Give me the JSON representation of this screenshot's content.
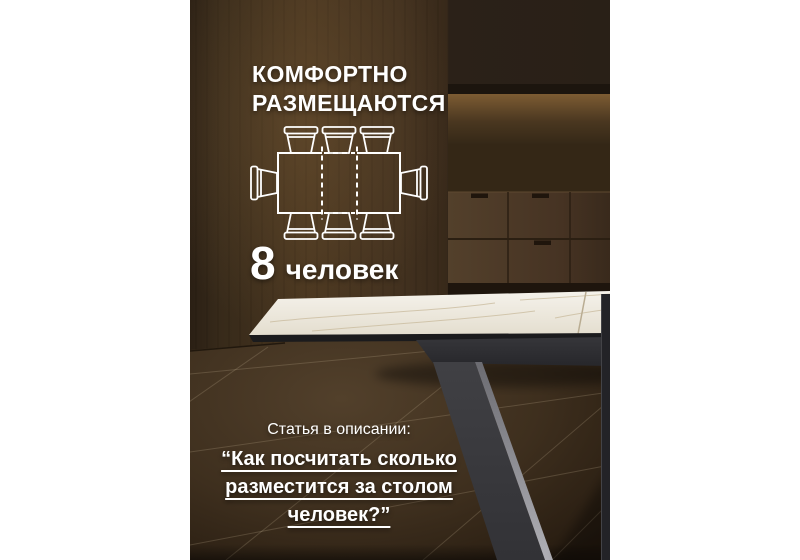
{
  "poster": {
    "heading": {
      "line1": "КОМФОРТНО",
      "line2": "РАЗМЕЩАЮТСЯ"
    },
    "capacity": {
      "number": "8",
      "label": "человек"
    },
    "footer": {
      "intro": "Статья в описании:",
      "quote_lines": {
        "0": "“Как посчитать сколько",
        "1": "разместится за столом",
        "2": "человек?”"
      }
    },
    "diagram": {
      "icon": "table-seating-top-view-icon",
      "total_seats": 8,
      "seats_top": 3,
      "seats_bottom": 3,
      "seats_left": 1,
      "seats_right": 1,
      "extension_leaf": "dashed center section"
    }
  },
  "colors": {
    "page_margin": "#ffffff",
    "overlay_text": "#ffffff",
    "wall_dark": "#2b2118",
    "wall_mid": "#48351f",
    "niche_glow": "#7d5c33",
    "cabinet_wood": "#4d3a27",
    "floor_brown": "#4a3825",
    "marble_top": "#f2efe7",
    "marble_vein": "#cbbda0",
    "table_frame": "#2c2c30",
    "leg_charcoal": "#3a3a3e",
    "leg_highlight": "#a4a4aa"
  }
}
